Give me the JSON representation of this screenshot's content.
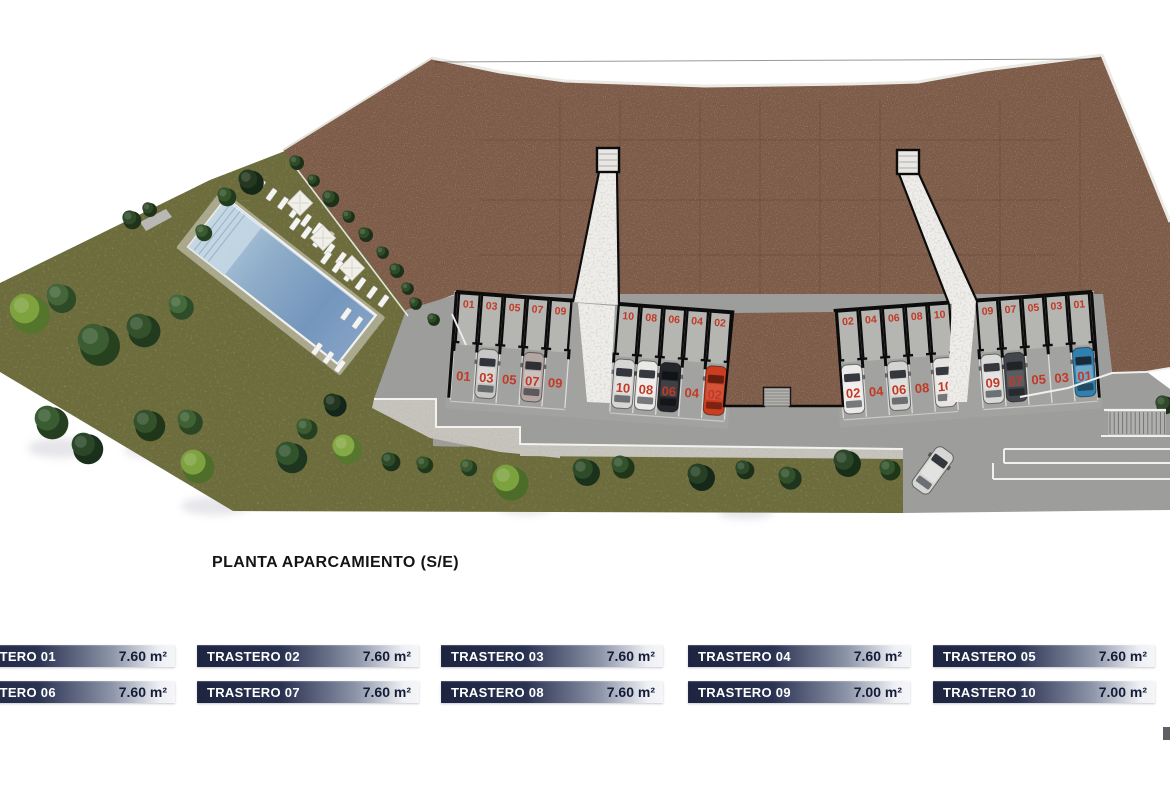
{
  "title": "PLANTA APARCAMIENTO (S/E)",
  "colors": {
    "red_number": "#c23a26",
    "roof_brown": "#7d5b49",
    "lawn_green": "#6f6d3e",
    "road_gray": "#9d9d9b",
    "pool_blue": "#7f9ec2",
    "legend_bar_dark": "#1d2440",
    "legend_bar_light": "#f5f6f8"
  },
  "legend": {
    "items": [
      {
        "label": "TRASTERO 01",
        "area": "7.60 m²"
      },
      {
        "label": "TRASTERO 02",
        "area": "7.60 m²"
      },
      {
        "label": "TRASTERO 03",
        "area": "7.60 m²"
      },
      {
        "label": "TRASTERO 04",
        "area": "7.60 m²"
      },
      {
        "label": "TRASTERO 05",
        "area": "7.60 m²"
      },
      {
        "label": "TRASTERO 06",
        "area": "7.60 m²"
      },
      {
        "label": "TRASTERO 07",
        "area": "7.60 m²"
      },
      {
        "label": "TRASTERO 08",
        "area": "7.60 m²"
      },
      {
        "label": "TRASTERO 09",
        "area": "7.00 m²"
      },
      {
        "label": "TRASTERO 10",
        "area": "7.00 m²"
      }
    ]
  },
  "plan": {
    "clusters": [
      {
        "id": "left",
        "boxes_left": [
          "01",
          "03",
          "05",
          "07",
          "09"
        ],
        "boxes_right": [
          "10",
          "08",
          "06",
          "04",
          "02"
        ],
        "stalls_left": [
          "01",
          "03",
          "05",
          "07",
          "09"
        ],
        "stalls_right": [
          "10",
          "08",
          "06",
          "04",
          "02"
        ]
      },
      {
        "id": "right",
        "boxes_left": [
          "02",
          "04",
          "06",
          "08",
          "10"
        ],
        "boxes_right": [
          "09",
          "07",
          "05",
          "03",
          "01"
        ],
        "stalls_left": [
          "02",
          "04",
          "06",
          "08",
          "10"
        ],
        "stalls_right": [
          "09",
          "07",
          "05",
          "03",
          "01"
        ]
      }
    ],
    "cars": [
      {
        "cluster": "left",
        "stall": "03",
        "color": "#c7c7c5"
      },
      {
        "cluster": "left",
        "stall": "07",
        "color": "#b3a5a1"
      },
      {
        "cluster": "left",
        "stall": "10",
        "color": "#d6d6d4"
      },
      {
        "cluster": "left",
        "stall": "08",
        "color": "#ebe9e7"
      },
      {
        "cluster": "left",
        "stall": "06",
        "color": "#23262b"
      },
      {
        "cluster": "left",
        "stall": "02",
        "color": "#cd3c1e"
      },
      {
        "cluster": "right",
        "stall": "02",
        "color": "#eceae8"
      },
      {
        "cluster": "right",
        "stall": "06",
        "color": "#d3d3d1"
      },
      {
        "cluster": "right",
        "stall": "10",
        "color": "#e7e4e1"
      },
      {
        "cluster": "right",
        "stall": "09",
        "color": "#d9d9d7"
      },
      {
        "cluster": "right",
        "stall": "07",
        "color": "#43474d"
      },
      {
        "cluster": "right",
        "stall": "01",
        "color": "#2f80b0"
      },
      {
        "cluster": "road",
        "stall": "",
        "color": "#d6d6d4"
      }
    ]
  }
}
